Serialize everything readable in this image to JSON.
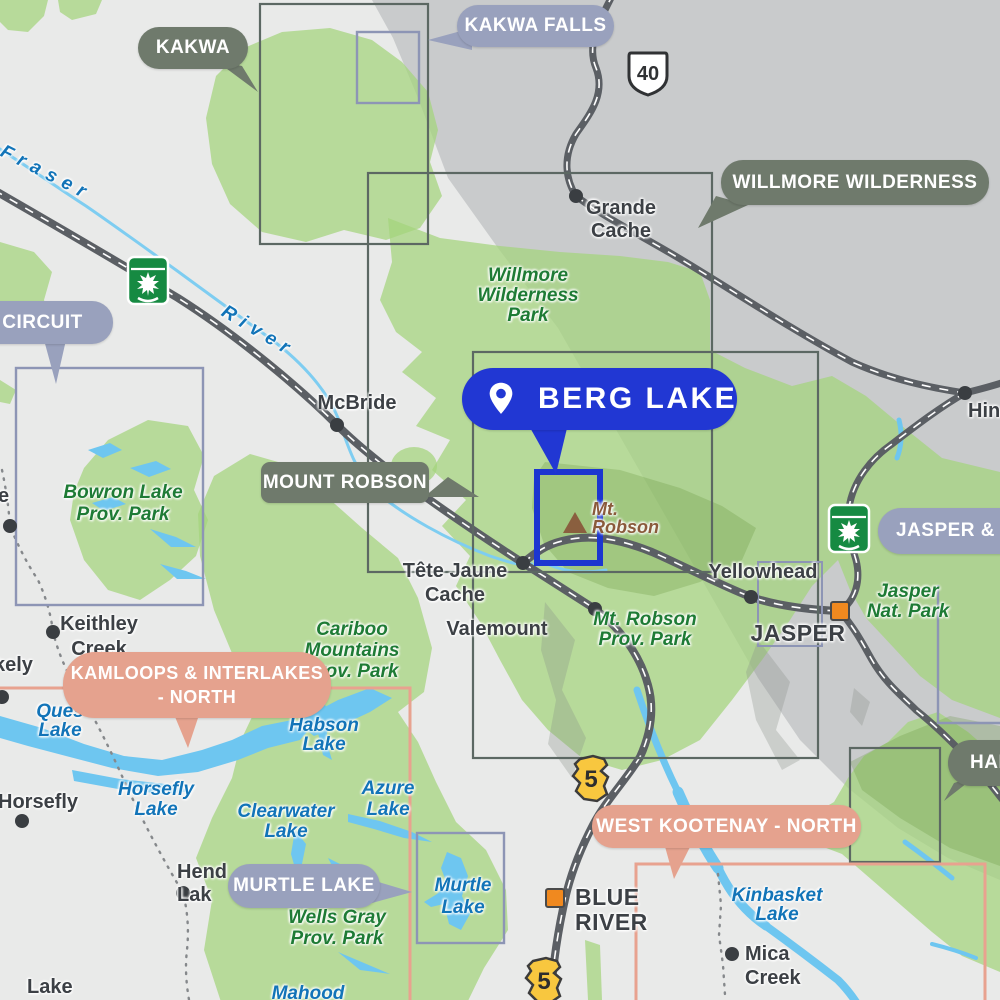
{
  "map_region": "Berg Lake / Mount Robson area trail index map",
  "badges": {
    "kakwa": {
      "label": "KAKWA"
    },
    "kakwa_falls": {
      "label": "KAKWA FALLS"
    },
    "willmore_wilderness": {
      "label": "WILLMORE WILDERNESS"
    },
    "circuit": {
      "label": "CIRCUIT"
    },
    "mount_robson": {
      "label": "MOUNT ROBSON"
    },
    "berg_lake": {
      "label": "BERG LAKE"
    },
    "jasper_area": {
      "label": "JASPER & A"
    },
    "kamloops": {
      "lines": [
        "KAMLOOPS & INTERLAKES",
        "- NORTH"
      ]
    },
    "murtle_lake": {
      "label": "MURTLE LAKE"
    },
    "west_kootenay": {
      "label": "WEST KOOTENAY - NORTH"
    },
    "hamber": {
      "label": "HAM"
    }
  },
  "towns": {
    "grande_cache": {
      "lines": [
        "Grande",
        "Cache"
      ]
    },
    "mcbride": {
      "label": "McBride"
    },
    "tete_jaune_cache": {
      "lines": [
        "Tête Jaune",
        "Cache"
      ]
    },
    "valemount": {
      "label": "Valemount"
    },
    "yellowhead": {
      "label": "Yellowhead"
    },
    "jasper": {
      "label": "JASPER"
    },
    "hinton": {
      "label": "Hin"
    },
    "keithley_creek": {
      "lines": [
        "Keithley",
        "Creek"
      ]
    },
    "horsefly": {
      "label": "Horsefly"
    },
    "likely": {
      "label": "kely"
    },
    "cutoff_e": {
      "label": "e"
    },
    "hendrix": {
      "lines": [
        "Hend",
        "Lak"
      ]
    },
    "blue_river": {
      "lines": [
        "BLUE",
        "RIVER"
      ]
    },
    "mica_creek": {
      "lines": [
        "Mica",
        "Creek"
      ]
    },
    "lake_town": {
      "label": "Lake"
    }
  },
  "parks": {
    "willmore": {
      "lines": [
        "Willmore",
        "Wilderness",
        "Park"
      ]
    },
    "bowron": {
      "lines": [
        "Bowron Lake",
        "Prov. Park"
      ]
    },
    "cariboo": {
      "lines": [
        "Cariboo",
        "Mountains",
        "Prov. Park"
      ]
    },
    "mt_robson": {
      "lines": [
        "Mt. Robson",
        "Prov. Park"
      ]
    },
    "jasper_np": {
      "lines": [
        "Jasper",
        "Nat. Park"
      ]
    },
    "wells_gray": {
      "lines": [
        "Wells Gray",
        "Prov. Park"
      ]
    }
  },
  "lakes": {
    "fraser": {
      "label": "Fraser"
    },
    "river": {
      "label": "River"
    },
    "quesnel": {
      "lines": [
        "Ques",
        "Lake"
      ]
    },
    "horsefly_lake": {
      "lines": [
        "Horsefly",
        "Lake"
      ]
    },
    "habson": {
      "lines": [
        "Habson",
        "Lake"
      ]
    },
    "azure": {
      "lines": [
        "Azure",
        "Lake"
      ]
    },
    "clearwater": {
      "lines": [
        "Clearwater",
        "Lake"
      ]
    },
    "murtle": {
      "lines": [
        "Murtle",
        "Lake"
      ]
    },
    "kinbasket": {
      "lines": [
        "Kinbasket",
        "Lake"
      ]
    },
    "mahood": {
      "label": "Mahood"
    }
  },
  "mountain": {
    "lines": [
      "Mt.",
      "Robson"
    ]
  },
  "shields": {
    "hwy40": "40",
    "hwy5": "5"
  },
  "colors": {
    "accent_blue": "#2137d3",
    "highlight_box": "#1c36d0",
    "olive_badge": "#6f7a6c",
    "periwinkle_badge": "#99a1bd",
    "salmon_badge": "#e5a28e",
    "bc_background": "#e9eae9",
    "alberta_gray": "#c9cbcc",
    "park_label_green": "#1e7b35",
    "lake_label_blue": "#1274b8",
    "water_blue": "#6ec6f0",
    "road_gray": "#5b5f64",
    "town_text": "#3c4045",
    "mountain_brown": "#8a5a3b",
    "hwy5_yellow": "#f8c73f",
    "hwy16_green": "#168a42",
    "marker_orange": "#f0891f"
  }
}
